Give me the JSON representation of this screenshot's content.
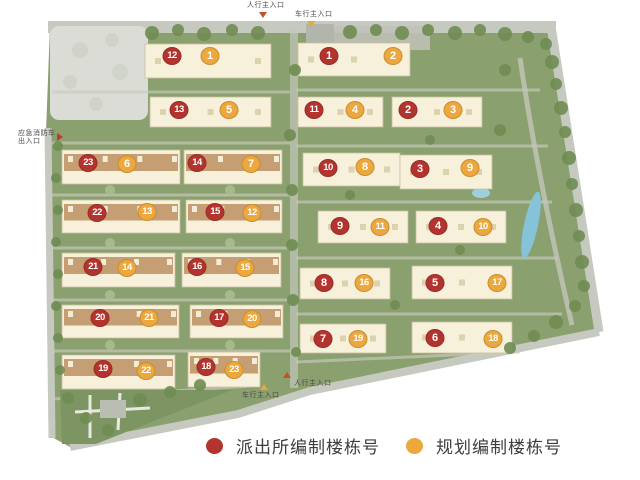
{
  "map_title": "residential-compound-site-plan",
  "colors": {
    "police_marker": "#b3342e",
    "plan_marker": "#eca73d",
    "pedestrian_entrance": "#c94f28",
    "vehicle_entrance": "#e9a73b",
    "emergency_entrance": "#c0392b"
  },
  "legend": {
    "items": [
      {
        "id": "police",
        "label": "派出所编制楼栋号",
        "color": "#b3342e"
      },
      {
        "id": "plan",
        "label": "规划编制楼栋号",
        "color": "#eca73d"
      }
    ]
  },
  "entrances": [
    {
      "id": "pedestrian-top",
      "label": "人行主入口",
      "dir": "down",
      "color": "#c94f28",
      "lx": 247,
      "ly": 2,
      "tx": 263,
      "ty": 12
    },
    {
      "id": "vehicle-top",
      "label": "车行主入口",
      "dir": "down",
      "color": "#e9a73b",
      "lx": 295,
      "ly": 11,
      "tx": 311,
      "ty": 21
    },
    {
      "id": "emergency-left",
      "label": "应急消防车",
      "label2": "出入口",
      "dir": "right",
      "color": "#c0392b",
      "lx": 18,
      "ly": 130,
      "tx": 60,
      "ty": 133
    },
    {
      "id": "pedestrian-bottom",
      "label": "人行主入口",
      "dir": "up",
      "color": "#c94f28",
      "lx": 294,
      "ly": 380,
      "tx": 287,
      "ty": 372
    },
    {
      "id": "vehicle-bottom",
      "label": "车行主入口",
      "dir": "up",
      "color": "#e9a73b",
      "lx": 242,
      "ly": 392,
      "tx": 264,
      "ty": 384
    }
  ],
  "markers": [
    {
      "type": "police",
      "n": 12,
      "x": 172,
      "y": 56
    },
    {
      "type": "plan",
      "n": 1,
      "x": 210,
      "y": 56
    },
    {
      "type": "police",
      "n": 1,
      "x": 329,
      "y": 56
    },
    {
      "type": "plan",
      "n": 2,
      "x": 393,
      "y": 56
    },
    {
      "type": "police",
      "n": 13,
      "x": 179,
      "y": 110
    },
    {
      "type": "plan",
      "n": 5,
      "x": 229,
      "y": 110
    },
    {
      "type": "police",
      "n": 11,
      "x": 314,
      "y": 110
    },
    {
      "type": "plan",
      "n": 4,
      "x": 355,
      "y": 110
    },
    {
      "type": "police",
      "n": 2,
      "x": 408,
      "y": 110
    },
    {
      "type": "plan",
      "n": 3,
      "x": 453,
      "y": 110
    },
    {
      "type": "police",
      "n": 23,
      "x": 88,
      "y": 163
    },
    {
      "type": "plan",
      "n": 6,
      "x": 127,
      "y": 164
    },
    {
      "type": "police",
      "n": 14,
      "x": 197,
      "y": 163
    },
    {
      "type": "plan",
      "n": 7,
      "x": 251,
      "y": 164
    },
    {
      "type": "police",
      "n": 10,
      "x": 328,
      "y": 168
    },
    {
      "type": "plan",
      "n": 8,
      "x": 365,
      "y": 167
    },
    {
      "type": "police",
      "n": 3,
      "x": 420,
      "y": 169
    },
    {
      "type": "plan",
      "n": 9,
      "x": 470,
      "y": 168
    },
    {
      "type": "police",
      "n": 22,
      "x": 97,
      "y": 213
    },
    {
      "type": "plan",
      "n": 13,
      "x": 147,
      "y": 212
    },
    {
      "type": "police",
      "n": 15,
      "x": 215,
      "y": 212
    },
    {
      "type": "plan",
      "n": 12,
      "x": 252,
      "y": 213
    },
    {
      "type": "police",
      "n": 9,
      "x": 340,
      "y": 226
    },
    {
      "type": "plan",
      "n": 11,
      "x": 380,
      "y": 227
    },
    {
      "type": "police",
      "n": 4,
      "x": 438,
      "y": 226
    },
    {
      "type": "plan",
      "n": 10,
      "x": 483,
      "y": 227
    },
    {
      "type": "police",
      "n": 21,
      "x": 93,
      "y": 267
    },
    {
      "type": "plan",
      "n": 14,
      "x": 127,
      "y": 268
    },
    {
      "type": "police",
      "n": 16,
      "x": 197,
      "y": 267
    },
    {
      "type": "plan",
      "n": 15,
      "x": 245,
      "y": 268
    },
    {
      "type": "police",
      "n": 8,
      "x": 324,
      "y": 283
    },
    {
      "type": "plan",
      "n": 16,
      "x": 364,
      "y": 283
    },
    {
      "type": "police",
      "n": 5,
      "x": 435,
      "y": 283
    },
    {
      "type": "plan",
      "n": 17,
      "x": 497,
      "y": 283
    },
    {
      "type": "police",
      "n": 20,
      "x": 100,
      "y": 318
    },
    {
      "type": "plan",
      "n": 21,
      "x": 149,
      "y": 318
    },
    {
      "type": "police",
      "n": 17,
      "x": 219,
      "y": 318
    },
    {
      "type": "plan",
      "n": 20,
      "x": 252,
      "y": 319
    },
    {
      "type": "police",
      "n": 7,
      "x": 323,
      "y": 339
    },
    {
      "type": "plan",
      "n": 19,
      "x": 358,
      "y": 339
    },
    {
      "type": "police",
      "n": 6,
      "x": 435,
      "y": 338
    },
    {
      "type": "plan",
      "n": 18,
      "x": 493,
      "y": 339
    },
    {
      "type": "police",
      "n": 19,
      "x": 103,
      "y": 369
    },
    {
      "type": "plan",
      "n": 22,
      "x": 146,
      "y": 371
    },
    {
      "type": "police",
      "n": 18,
      "x": 206,
      "y": 367
    },
    {
      "type": "plan",
      "n": 23,
      "x": 234,
      "y": 370
    }
  ]
}
